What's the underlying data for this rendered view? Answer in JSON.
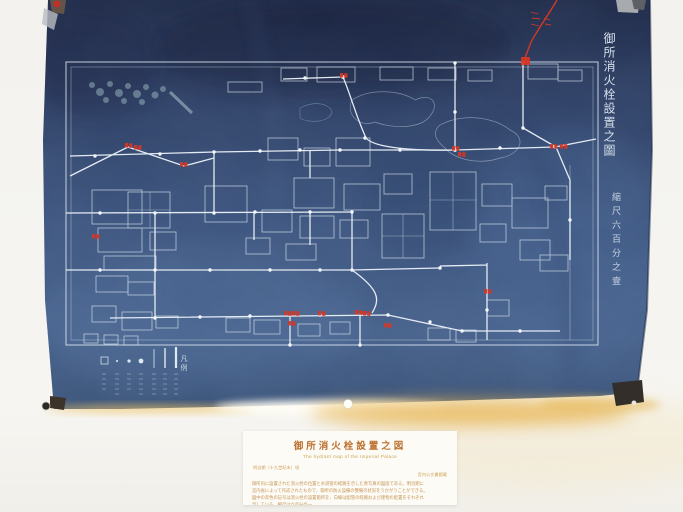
{
  "artifact": {
    "map_title": "御所消火栓設置之圖",
    "map_scale": "縮尺六百分之壹",
    "legend_title": "凡例"
  },
  "caption_card": {
    "title": "御所消火栓設置之図",
    "subtitle": "The hydrant map of the Imperial Palace",
    "meta_left": "明治期（十九世紀末）頃",
    "meta_right": "宮内公文書館蔵",
    "body_lines": [
      "御所内に設置された消火栓の位置と水道管の経路を示した青写真の図面である。明治期に",
      "宮内省によって作成されたもので、御所の防火設備の整備の状況をうかがうことができる。",
      "図中の赤色の記号は消火栓の設置箇所を、白線は配管の経路および建物の配置をそれぞれ",
      "示している。縮尺は六百分の一。"
    ]
  },
  "colors": {
    "blueprint_blue": "#35507a",
    "line_white": "#e8f0f8",
    "marker_red": "#d63726",
    "caption_orange": "#bd7230",
    "glow_gold": "#e2af49"
  }
}
